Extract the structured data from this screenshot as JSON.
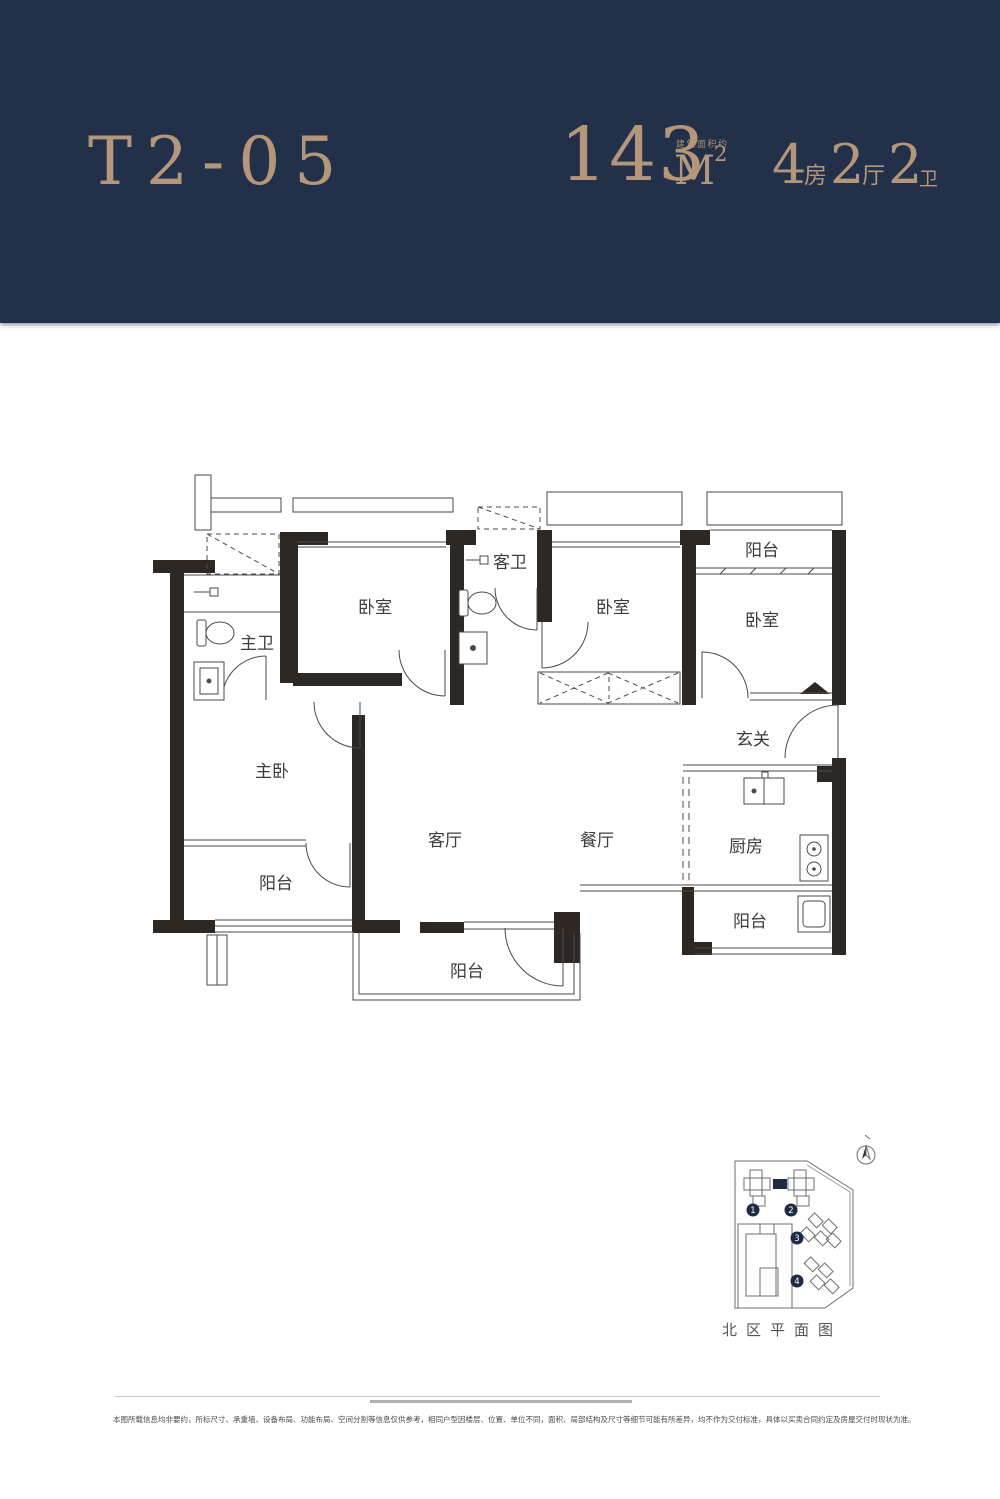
{
  "header": {
    "unit_code": "T2-05",
    "area": {
      "value": "143",
      "unit": "M",
      "sup": "2",
      "note": "建筑面积约"
    },
    "layout_spec": [
      {
        "num": "4",
        "unit": "房"
      },
      {
        "num": "2",
        "unit": "厅"
      },
      {
        "num": "2",
        "unit": "卫"
      }
    ]
  },
  "floorplan": {
    "labels": {
      "master_bath": "主卫",
      "bedroom_a": "卧室",
      "guest_bath": "客卫",
      "bedroom_b": "卧室",
      "balcony_top": "阳台",
      "bedroom_c": "卧室",
      "foyer": "玄关",
      "master_bedroom": "主卧",
      "living": "客厅",
      "dining": "餐厅",
      "kitchen": "厨房",
      "balcony_left": "阳台",
      "balcony_kitchen": "阳台",
      "balcony_bottom": "阳台"
    }
  },
  "siteplan": {
    "caption": "北区平面图",
    "markers": [
      "1",
      "2",
      "3",
      "4"
    ]
  },
  "footer": {
    "disclaimer": "本图所载信息均非要约，所标尺寸、承重墙、设备布局、功能布局、空间分割等信息仅供参考，相同户型因楼层、位置、单位不同，面积、局部结构及尺寸等细节可能有所差异，均不作为交付标准，具体以买卖合同约定及房屋交付时现状为准。"
  },
  "theme": {
    "navy": "#233049",
    "gold": "#b4977a",
    "wall": "#2e2824",
    "line": "#4a4a4a"
  }
}
